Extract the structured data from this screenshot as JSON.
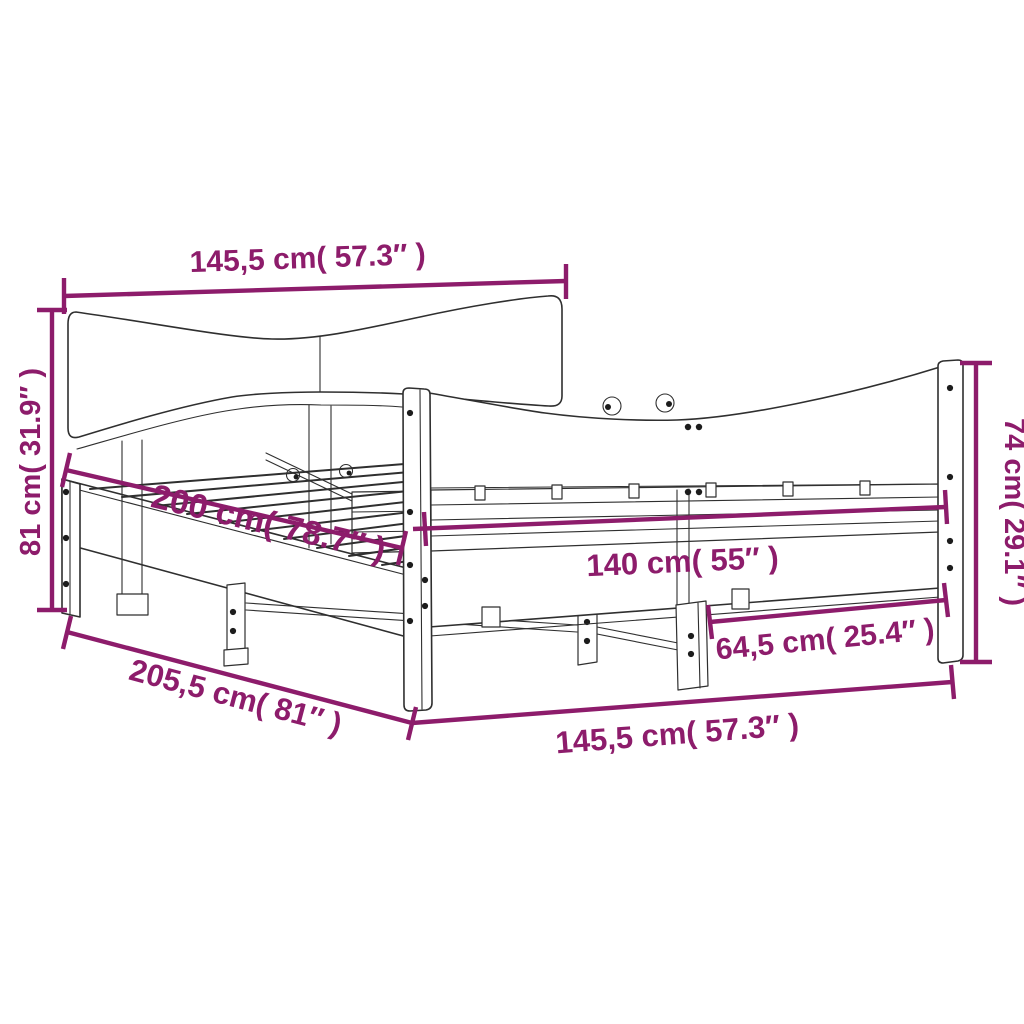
{
  "diagram": {
    "type": "product-dimension-diagram",
    "product": "bed frame with wavy headboard and footboard",
    "background_color": "#ffffff",
    "line_color": "#2f2f2f",
    "dimension_color": "#8D1C6B",
    "dimensions": {
      "headboard_width": "145,5 cm( 57.3″ )",
      "headboard_height": "81 cm( 31.9″ )",
      "bed_length": "200 cm( 78.7″ )",
      "bed_width": "140 cm( 55″ )",
      "footboard_height": "74 cm( 29.1″ )",
      "footboard_half_width": "64,5 cm( 25.4″ )",
      "total_length": "205,5 cm( 81″ )",
      "total_width": "145,5 cm( 57.3″ )"
    }
  }
}
